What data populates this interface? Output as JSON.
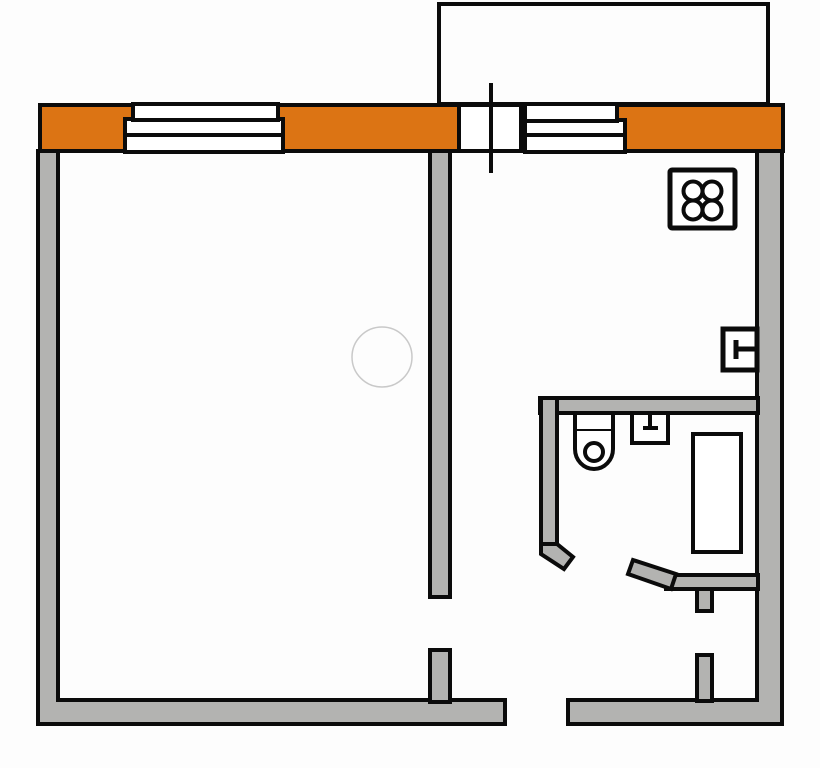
{
  "colors": {
    "background": "#FDFDFD",
    "outline": "#0B0B0B",
    "wall_fill": "#B3B3B1",
    "accent_orange": "#DC7414",
    "fixture_fill": "#FFFFFF",
    "marker_stroke": "#C9C9C9"
  },
  "legend": {
    "balcony_outline": "open balcony footprint",
    "facade_wall": "insulated exterior facade wall (orange)",
    "window_left": "triple-line window symbol, living room",
    "window_right": "triple-line window symbol, kitchen",
    "balcony_door": "balcony door opening with door leaf line",
    "stove_icon": "four-burner cooktop",
    "kitchen_sink_icon": "wall faucet / sink tap",
    "toilet_icon": "toilet with cistern",
    "washbasin_icon": "washbasin with tap",
    "bathtub_icon": "bathtub",
    "entrance_opening": "apartment entrance door gap",
    "room_circle_marker": "round floor marker in living room"
  }
}
